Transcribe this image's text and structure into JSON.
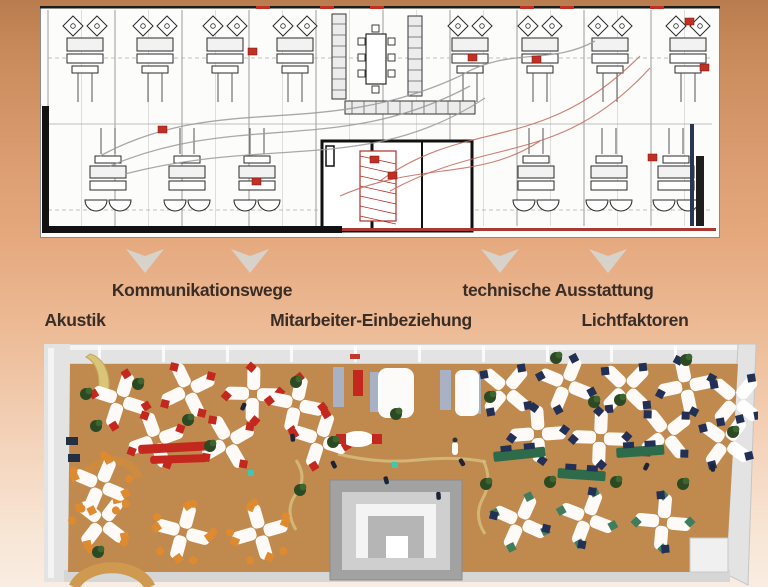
{
  "background": {
    "top": "#b97c4e",
    "mid": "#e5a87d",
    "bottom": "#f9ece1"
  },
  "labels": {
    "color": "#3a2d26",
    "row1": [
      {
        "text": "Kommunikationswege",
        "x": 202,
        "y": 280
      },
      {
        "text": "technische Ausstattung",
        "x": 558,
        "y": 280
      }
    ],
    "row2": [
      {
        "text": "Akustik",
        "x": 75,
        "y": 310
      },
      {
        "text": "Mitarbeiter-Einbeziehung",
        "x": 371,
        "y": 310
      },
      {
        "text": "Lichtfaktoren",
        "x": 635,
        "y": 310
      }
    ]
  },
  "arrows": {
    "color": "#d6d6d1",
    "y": 247,
    "width": 38,
    "height": 26,
    "positions_x": [
      145,
      250,
      500,
      608
    ]
  },
  "floor_plan": {
    "x": 40,
    "y": 6,
    "width": 680,
    "height": 232,
    "paper": "#fcfcfa",
    "ink": "#2a2a2a",
    "grid": "#c9c9c9",
    "accent": "#c03024",
    "curve_gray": "#9a9a9a",
    "curve_red": "#c4685a",
    "top_cluster_x": [
      45,
      115,
      185,
      255,
      430,
      500,
      570,
      648
    ],
    "bottom_cluster_x": [
      68,
      147,
      217,
      496,
      569,
      636
    ],
    "red_marks": [
      [
        208,
        42
      ],
      [
        428,
        48
      ],
      [
        492,
        50
      ],
      [
        645,
        12
      ],
      [
        212,
        172
      ],
      [
        330,
        150
      ],
      [
        348,
        166
      ],
      [
        608,
        148
      ],
      [
        118,
        120
      ],
      [
        660,
        58
      ]
    ],
    "red_top_dashes": [
      216,
      280,
      330,
      480,
      520,
      610
    ],
    "gray_curves": [
      "M60,150 C180,85 280,135 420,70",
      "M70,160 C200,105 300,150 430,80",
      "M85,168 C230,130 330,168 445,92",
      "M420,70 C470,40 510,60 555,35"
    ],
    "red_curves": [
      "M340,175 C430,110 500,150 600,50",
      "M350,185 C450,130 520,160 610,62",
      "M300,190 C380,155 440,175 500,135"
    ]
  },
  "render": {
    "x": 38,
    "y": 342,
    "width": 720,
    "height": 245,
    "floor": "#c08a4e",
    "wall": "#e3e3e3",
    "wall_dark": "#d6d6d6",
    "wall_light": "#f4f4f4",
    "desk": "#ffffff",
    "plant": "#2b4a24",
    "path": "#d4ba7c",
    "core_outer": "#a2a2a2",
    "core_mid": "#cfcfcf",
    "partition": "#a8b2c4",
    "table_green": "#2e6b4a",
    "seat_colors": {
      "red": "#c4271e",
      "navy": "#233055",
      "orange": "#df8a2e",
      "green": "#3f7d5e"
    },
    "clusters": [
      {
        "x": 82,
        "y": 58,
        "seat": "red"
      },
      {
        "x": 150,
        "y": 48,
        "seat": "red"
      },
      {
        "x": 215,
        "y": 52,
        "seat": "red"
      },
      {
        "x": 118,
        "y": 98,
        "seat": "red"
      },
      {
        "x": 190,
        "y": 100,
        "seat": "red"
      },
      {
        "x": 258,
        "y": 62,
        "seat": "red"
      },
      {
        "x": 282,
        "y": 98,
        "seat": "red"
      },
      {
        "x": 468,
        "y": 48,
        "seat": "navy"
      },
      {
        "x": 528,
        "y": 42,
        "seat": "navy"
      },
      {
        "x": 588,
        "y": 46,
        "seat": "navy"
      },
      {
        "x": 648,
        "y": 44,
        "seat": "navy"
      },
      {
        "x": 698,
        "y": 58,
        "seat": "navy"
      },
      {
        "x": 500,
        "y": 92,
        "seat": "navy"
      },
      {
        "x": 562,
        "y": 96,
        "seat": "navy"
      },
      {
        "x": 628,
        "y": 92,
        "seat": "navy"
      },
      {
        "x": 688,
        "y": 100,
        "seat": "navy"
      },
      {
        "x": 64,
        "y": 180,
        "seat": "orange"
      },
      {
        "x": 145,
        "y": 190,
        "seat": "orange"
      },
      {
        "x": 222,
        "y": 190,
        "seat": "orange"
      },
      {
        "x": 62,
        "y": 143,
        "seat": "orange"
      },
      {
        "x": 482,
        "y": 180,
        "seat": "green"
      },
      {
        "x": 549,
        "y": 176,
        "seat": "green"
      },
      {
        "x": 625,
        "y": 180,
        "seat": "green"
      }
    ],
    "tables_green": [
      [
        455,
        110,
        52,
        -6
      ],
      [
        520,
        126,
        48,
        4
      ],
      [
        578,
        106,
        48,
        -4
      ]
    ],
    "sofas_red": [
      [
        100,
        103,
        72,
        9,
        -3
      ],
      [
        112,
        114,
        58,
        8,
        -2
      ]
    ],
    "partitions": [
      [
        295,
        25
      ],
      [
        332,
        30
      ],
      [
        402,
        28
      ],
      [
        432,
        32
      ]
    ],
    "plants": [
      [
        48,
        52
      ],
      [
        58,
        84
      ],
      [
        150,
        78
      ],
      [
        172,
        104
      ],
      [
        258,
        40
      ],
      [
        295,
        100
      ],
      [
        358,
        72
      ],
      [
        452,
        55
      ],
      [
        518,
        16
      ],
      [
        582,
        58
      ],
      [
        648,
        18
      ],
      [
        262,
        148
      ],
      [
        448,
        142
      ],
      [
        512,
        140
      ],
      [
        578,
        140
      ],
      [
        645,
        142
      ],
      [
        695,
        90
      ],
      [
        100,
        42
      ],
      [
        556,
        60
      ],
      [
        60,
        210
      ]
    ],
    "people": [
      [
        292,
        120
      ],
      [
        345,
        135
      ],
      [
        252,
        92
      ],
      [
        420,
        118
      ],
      [
        205,
        60
      ],
      [
        608,
        120
      ],
      [
        672,
        122
      ],
      [
        398,
        150
      ]
    ],
    "teal_dots": [
      [
        354,
        120
      ],
      [
        210,
        128
      ]
    ]
  }
}
